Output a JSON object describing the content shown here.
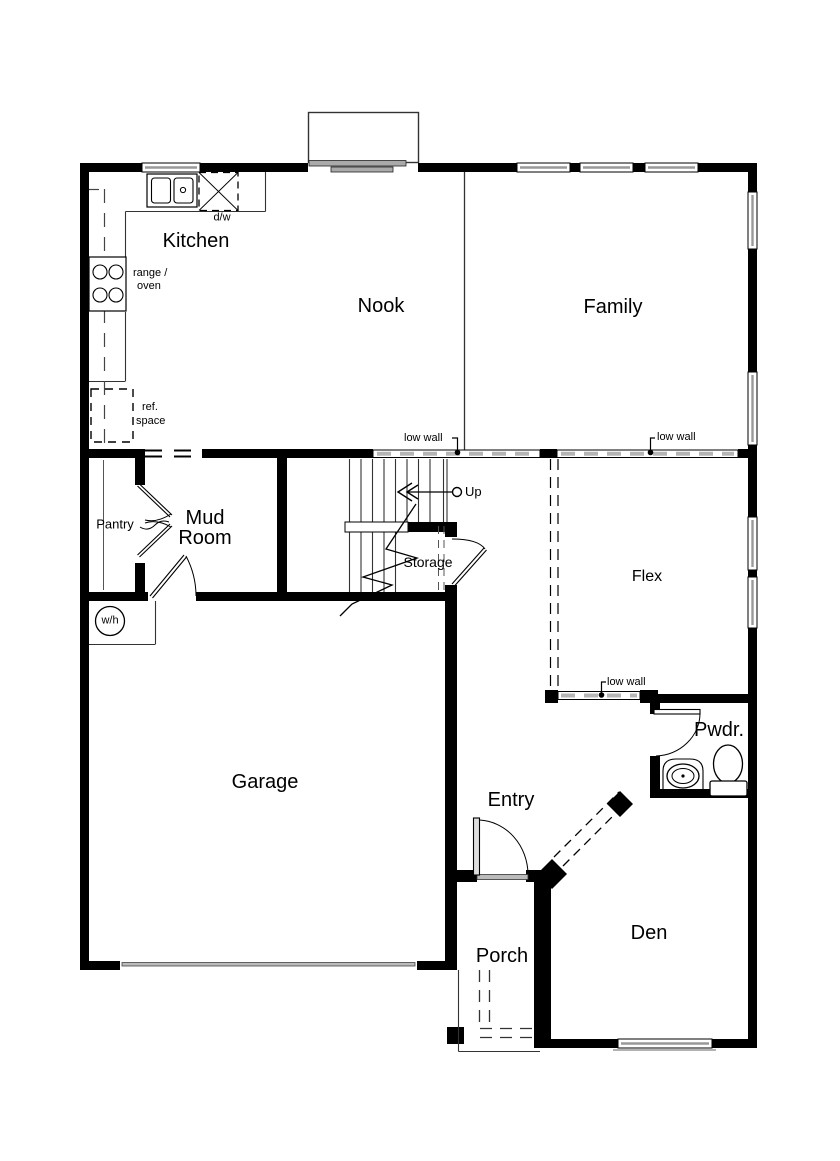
{
  "rooms": {
    "kitchen": "Kitchen",
    "nook": "Nook",
    "family": "Family",
    "pantry": "Pantry",
    "mud_room": {
      "line1": "Mud",
      "line2": "Room"
    },
    "storage": "Storage",
    "flex": "Flex",
    "garage": "Garage",
    "entry": "Entry",
    "powder": "Pwdr.",
    "den": "Den",
    "porch": "Porch"
  },
  "annotations": {
    "dishwasher": "d/w",
    "range": {
      "line1": "range /",
      "line2": "oven"
    },
    "ref_space": {
      "line1": "ref.",
      "line2": "space"
    },
    "low_wall_nook": "low wall",
    "low_wall_flex_top": "low wall",
    "low_wall_flex_bottom": "low wall",
    "up": "Up",
    "water_heater": "w/h"
  },
  "colors": {
    "wall": "#000000",
    "window_gray": "#999999",
    "low_wall_dash": "#b5b5b5",
    "background": "#ffffff"
  }
}
